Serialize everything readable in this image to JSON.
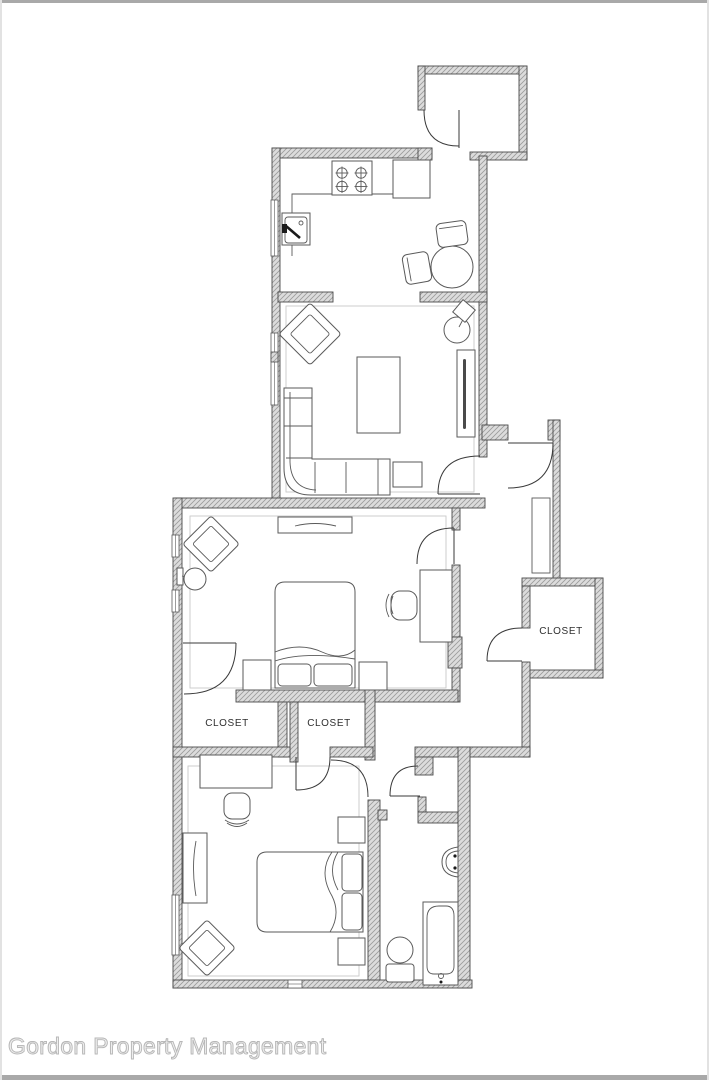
{
  "watermark": {
    "text": "Gordon Property Management",
    "color": "#c9c9c9"
  },
  "floor_plan": {
    "labels": {
      "closet_left": "CLOSET",
      "closet_middle": "CLOSET",
      "closet_hall": "CLOSET"
    },
    "colors": {
      "wall_fill": "#dcdcdc",
      "wall_hatch": "#9b9b9b",
      "wall_outline": "#4a4a4a",
      "door_line": "#3a3a3a",
      "furniture_line": "#5a5a5a",
      "floor_outline": "#c9c9c9",
      "page_background": "#ffffff",
      "frame_edge": "#a9a9a9"
    }
  }
}
